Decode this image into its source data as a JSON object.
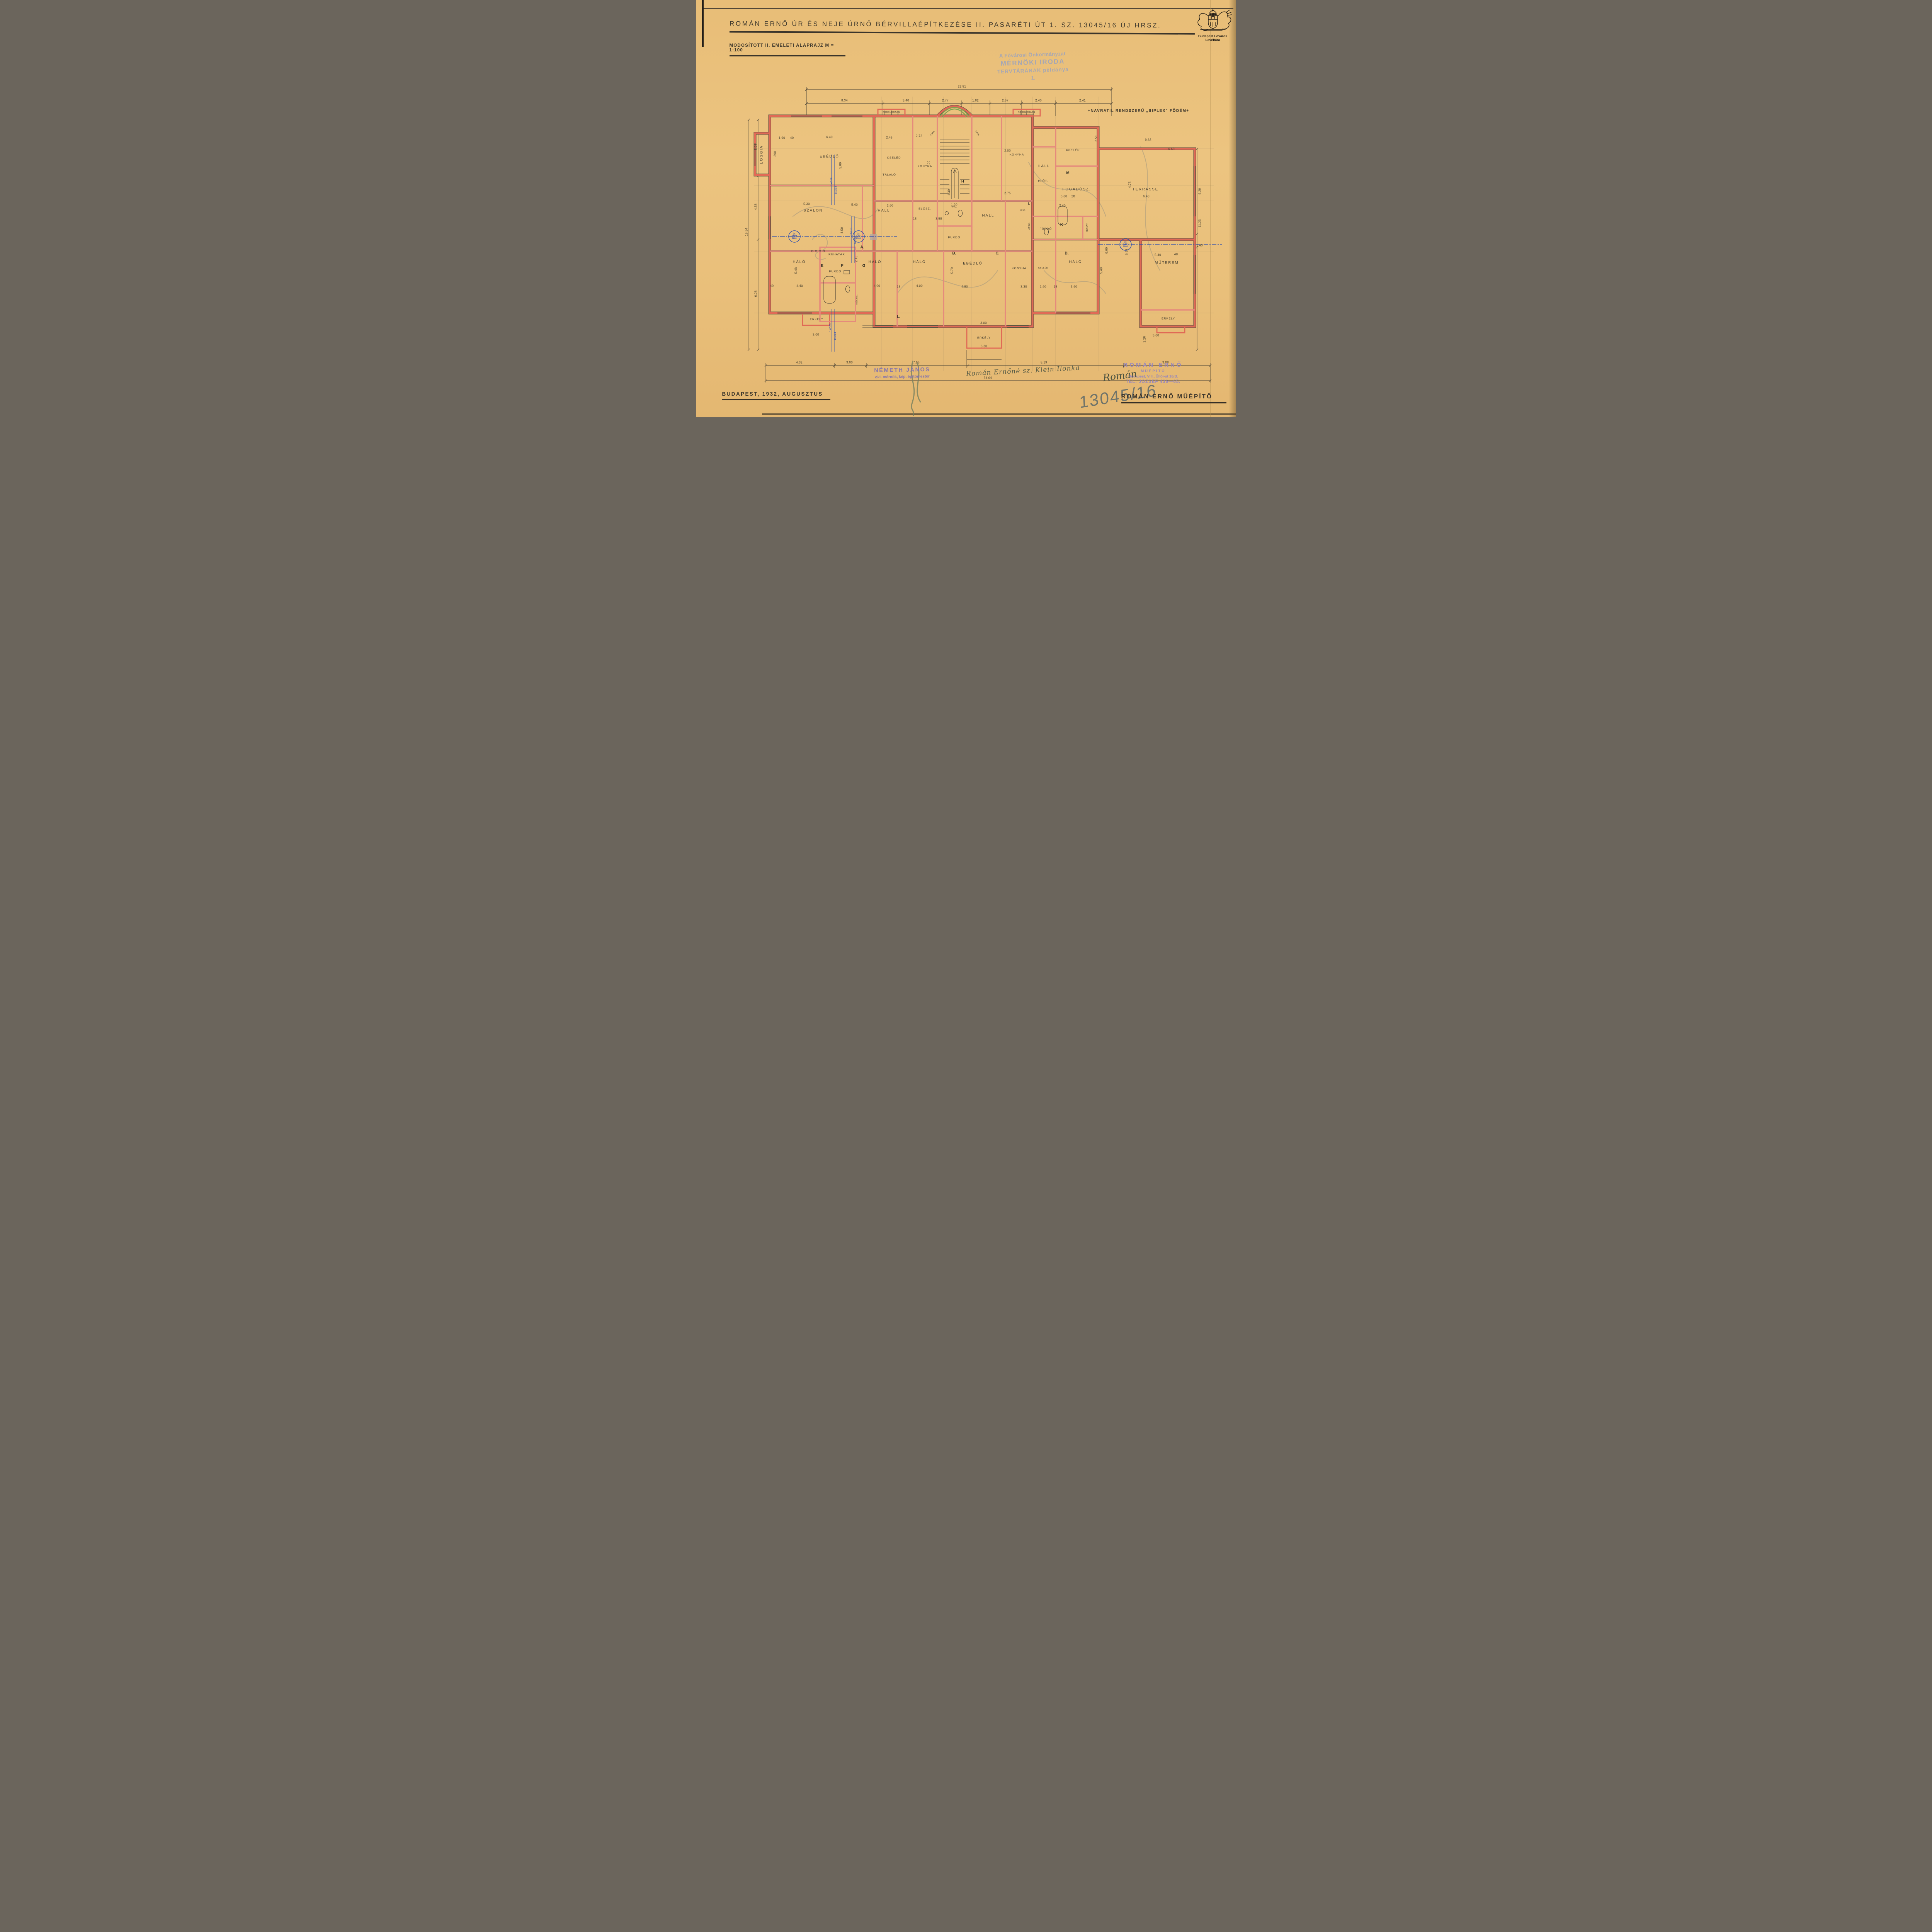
{
  "doc": {
    "title": "ROMÁN ERNŐ ÚR ÉS NEJE ÚRNŐ BÉRVILLAÉPÍTKEZÉSE II. PASARÉTI ÚT 1. SZ. 13045/16 ÚJ HRSZ.",
    "subtitle": "MODOSÍTOTT II. EMELETI ALAPRAJZ M = 1:100",
    "slab_note": "+NAVRATIL RENDSZERŰ „BIPLEX\" FÖDÉM+"
  },
  "archive": {
    "name": "Budapest Főváros Levéltára"
  },
  "office_stamp": {
    "line1": "A Fővárosi Önkormányzat",
    "line2": "MÉRNÖKI IRODA",
    "line3": "TERVTÁRÁNAK példánya",
    "line4": "1."
  },
  "rooms": {
    "loggia": "LOGGIA",
    "ebedlo_top": "EBÉDLŐ",
    "cseled_top": "CSELÉD",
    "talalo": "TÁLALÓ",
    "konyha_left": "KONYHA",
    "kam1": "KAM.",
    "kam2": "KAM.",
    "konyha_top": "KONYHA",
    "cseled_top_right": "CSELÉD",
    "hall_right": "HALL",
    "elot": "ELŐT.",
    "szalon": "SZALON",
    "hall_left": "HALL",
    "elosz": "ELŐSZ.",
    "wc1": "W.C.",
    "furdo_mid": "FÜRDŐ",
    "hall_main": "HALL",
    "wc2": "W.C.",
    "fogadosz": "FOGADÓSZ.",
    "terrasse": "TERRASSE",
    "ruhat": "RUHÁT.",
    "furdo_right": "FÜRDŐ",
    "halo1": "HÁLÓ",
    "ruhatar": "RUHATÁR",
    "furdo_left": "FÜRDŐ",
    "halo2": "HÁLÓ",
    "halo3": "HÁLÓ",
    "ebedlo_btm": "EBÉDLŐ",
    "konyha_btm": "KONYHA",
    "cseled_btm": "CSELÉD",
    "halo4": "HÁLÓ",
    "muterem": "MŰTEREM",
    "erkely_l": "ERKÉLY",
    "erkely_c": "ERKÉLY",
    "erkely_r": "ERKÉLY",
    "porolo1": "POROLÓRÁCS",
    "porolo2": "POROLÓRÁCS",
    "hoszig": "HŐSZIG.",
    "atsz": "ÁTSZ."
  },
  "letters": {
    "a": "A.",
    "b": "B.",
    "c": "C.",
    "d": "D.",
    "e": "E",
    "f": "F",
    "g": "G",
    "h": "H",
    "i": "I.",
    "k": "K",
    "l": "L.",
    "m": "M"
  },
  "dims": {
    "top_total": "22.81",
    "top": [
      "8.34",
      "3.40",
      "2.77",
      "1.82",
      "2.67",
      "2.40",
      "2.41"
    ],
    "bottom_total": "34.04",
    "bottom": [
      "4.32",
      "3.00",
      "7.95",
      "8.19",
      "3.08"
    ],
    "left_total": "15.94",
    "left": [
      "5.08",
      "4.58",
      "6.28"
    ],
    "right": [
      "6.20",
      "11.23",
      "1.43"
    ],
    "inner": [
      "1.90",
      "40",
      "390",
      "6.40",
      "5.00",
      "2.45",
      "2.72",
      "4.00",
      "2.00",
      "2.75",
      "5.30",
      "5.40",
      "2.60",
      "4.50",
      "15",
      "3.58",
      "1.20",
      "1.30",
      "3.51",
      "9.63",
      "6.60",
      "4.75",
      "3.80",
      "28",
      "6.40",
      "2.40",
      "6.00",
      "6.68",
      "5.48",
      "4.40",
      "40",
      "2.45",
      "4.00",
      "15",
      "4.00",
      "5.70",
      "4.80",
      "3.30",
      "1.60",
      "15",
      "3.60",
      "5.48",
      "5.40",
      "40",
      "3.00",
      "2.20",
      "3.00",
      "3.00",
      "5.60"
    ]
  },
  "rebar_notes": [
    "1x∅18",
    "1x∅14",
    "1x∅12",
    "1x∅10",
    "1x∅20",
    "1x∅14"
  ],
  "circle_stamps": {
    "c1": [
      "2x",
      "240/d",
      "5600"
    ],
    "c2": [
      "2x",
      "14∅",
      "2900"
    ],
    "c3": [
      "2x",
      "14∅",
      "2900"
    ]
  },
  "footer": {
    "date": "BUDAPEST, 1932, AUGUSZTUS",
    "nemeth_line1": "NÉMETH JÁNOS",
    "nemeth_line2": "okl. mérnök, kép. építőmester",
    "klein_signature": "Román Ernőné sz. Klein Ilonka",
    "roman_line1": "ROMÁN ERNŐ",
    "roman_line2": "MŰÉPÍTŐ",
    "roman_line3": "Budapest, VIII., Üllői-ut 16/B.",
    "roman_line4": "TEL. JÓZSEF 436—65.",
    "roman_signature": "Román",
    "plot_number": "13045/16",
    "name_plate": "ROMÁN ERNŐ MŰÉPÍTŐ"
  },
  "colors": {
    "paper": "#e9bf7b",
    "wall": "#e06a56",
    "ink": "#3e382c",
    "blue": "#2f4fae",
    "stamp_purple": "#8f80c0",
    "stamp_blue": "#99a2c0",
    "green": "#7fa24f",
    "pencil": "#938d7e"
  }
}
